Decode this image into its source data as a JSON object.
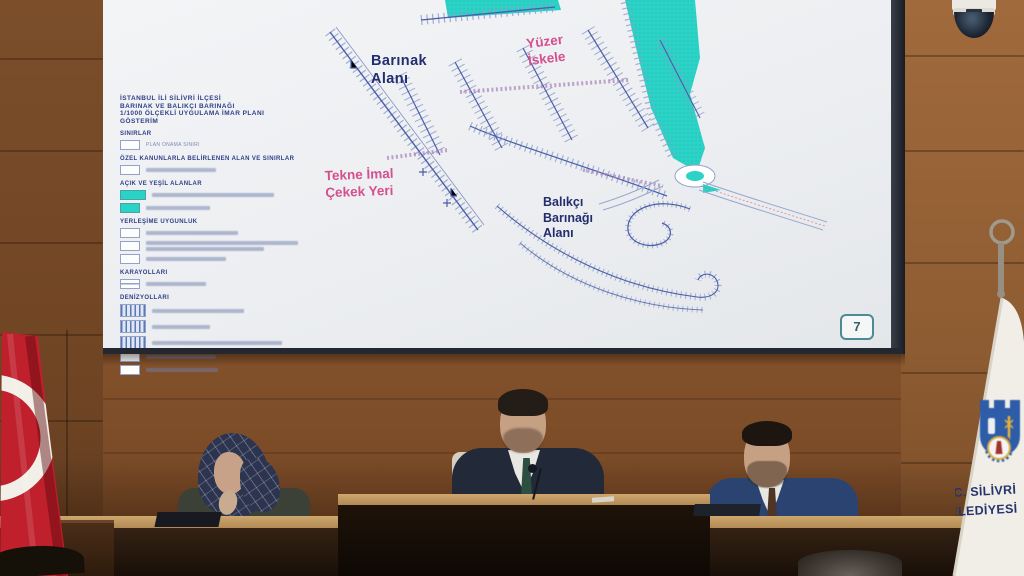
{
  "screen": {
    "plan": {
      "title_lines": [
        "İSTANBUL İLİ SİLİVRİ İLÇESİ",
        "BARINAK VE BALIKÇI BARINAĞI",
        "1/1000 ÖLÇEKLİ UYGULAMA İMAR PLANI",
        "GÖSTERİM"
      ],
      "legend_sections": {
        "sinirlar": "SINIRLAR",
        "ozel": "ÖZEL KANUNLARLA BELİRLENEN ALAN VE SINIRLAR",
        "acik": "AÇIK VE YEŞİL ALANLAR",
        "yerlesime": "YERLEŞİME UYGUNLUK",
        "karayollari": "KARAYOLLARI",
        "denizyollari": "DENİZYOLLARI"
      },
      "legend_items": {
        "plan_onama": "PLAN ONAMA SINIRI"
      },
      "map_labels": {
        "barinak": {
          "lines": [
            "Barınak",
            "Alanı"
          ]
        },
        "yuzer": {
          "lines": [
            "Yüzer",
            "İskele"
          ]
        },
        "tekne": {
          "lines": [
            "Tekne İmal",
            "Çekek Yeri"
          ]
        },
        "balikci": {
          "lines": [
            "Balıkçı",
            "Barınağı",
            "Alanı"
          ]
        }
      },
      "page_number": "7"
    }
  },
  "banner": {
    "line1": "T.C. SİLİVRİ",
    "line2": "BELEDİYESİ"
  },
  "colors": {
    "map_cyan": "#2bd2c6",
    "map_line_blue": "#4a5da8",
    "map_label_navy": "#222e6e",
    "map_label_pink": "#d4508e",
    "flag_red": "#bf202c",
    "banner_navy": "#24356e",
    "wall_wood": "#8a5830"
  }
}
